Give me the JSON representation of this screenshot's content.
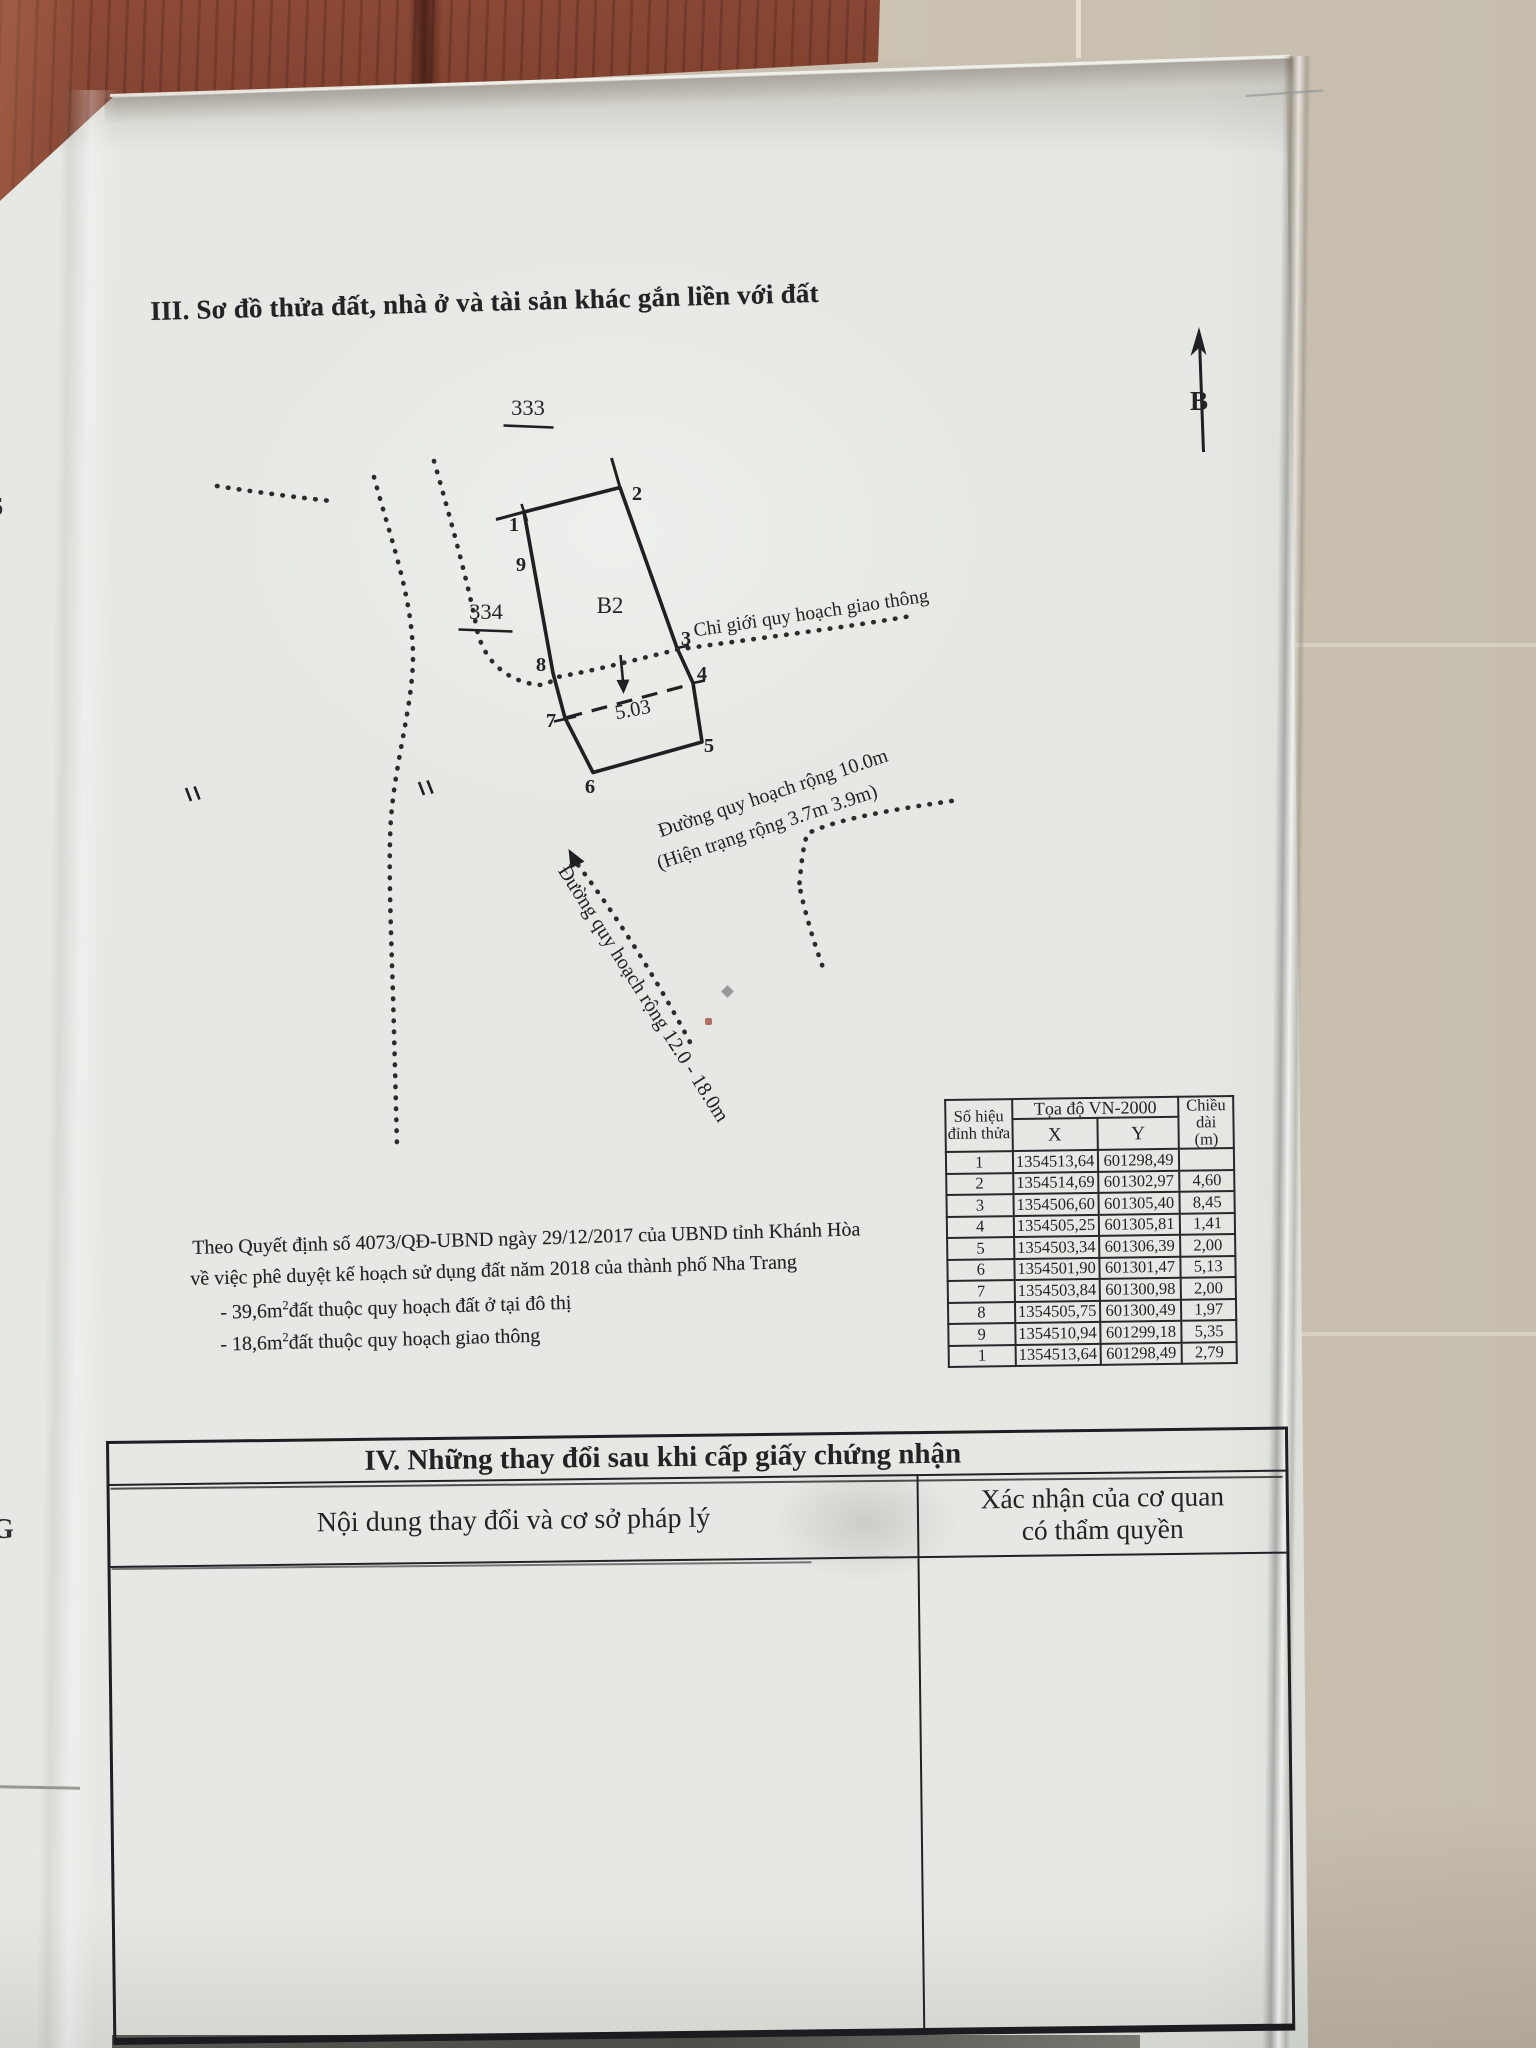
{
  "page": {
    "section3_title": "III. Sơ đồ thửa đất, nhà ở và tài sản khác gắn liền với đất",
    "diagram": {
      "parcel_label": "B2",
      "adjacent_parcel_top": "333",
      "adjacent_parcel_left": "334",
      "north_label": "B",
      "dim_label": "5.03",
      "boundary_label": "Chỉ giới quy hoạch giao thông",
      "road1_line1": "Đường quy hoạch rộng 10.0m",
      "road1_line2": "(Hiện trạng rộng 3.7m 3.9m)",
      "road2": "Đường quy hoạch rộng 12.0 - 18.0m",
      "vertices": [
        "1",
        "2",
        "3",
        "4",
        "5",
        "6",
        "7",
        "8",
        "9"
      ],
      "edge_fragment_top": "6",
      "edge_fragment_bottom": "G"
    },
    "coord_table": {
      "header_col1_line1": "Số hiệu",
      "header_col1_line2": "đỉnh thửa",
      "header_span": "Tọa độ VN-2000",
      "header_x": "X",
      "header_y": "Y",
      "header_len_line1": "Chiều",
      "header_len_line2": "dài",
      "header_len_line3": "(m)",
      "rows": [
        {
          "id": "1",
          "x": "1354513,64",
          "y": "601298,49",
          "len": ""
        },
        {
          "id": "2",
          "x": "1354514,69",
          "y": "601302,97",
          "len": "4,60"
        },
        {
          "id": "3",
          "x": "1354506,60",
          "y": "601305,40",
          "len": "8,45"
        },
        {
          "id": "4",
          "x": "1354505,25",
          "y": "601305,81",
          "len": "1,41"
        },
        {
          "id": "5",
          "x": "1354503,34",
          "y": "601306,39",
          "len": "2,00"
        },
        {
          "id": "6",
          "x": "1354501,90",
          "y": "601301,47",
          "len": "5,13"
        },
        {
          "id": "7",
          "x": "1354503,84",
          "y": "601300,98",
          "len": "2,00"
        },
        {
          "id": "8",
          "x": "1354505,75",
          "y": "601300,49",
          "len": "1,97"
        },
        {
          "id": "9",
          "x": "1354510,94",
          "y": "601299,18",
          "len": "5,35"
        },
        {
          "id": "1",
          "x": "1354513,64",
          "y": "601298,49",
          "len": "2,79"
        }
      ]
    },
    "notes": {
      "line1": "Theo Quyết định số 4073/QĐ-UBND ngày 29/12/2017 của UBND tỉnh Khánh Hòa",
      "line2": "về việc phê duyệt kế hoạch sử dụng đất năm 2018 của thành phố Nha Trang",
      "item1_prefix": "- 39,6m",
      "item1_sup": "2",
      "item1_rest": "đất thuộc quy hoạch đất ở tại đô thị",
      "item2_prefix": "- 18,6m",
      "item2_sup": "2",
      "item2_rest": "đất thuộc quy hoạch giao thông"
    },
    "section4": {
      "title": "IV. Những thay đổi sau khi cấp giấy chứng nhận",
      "col_left": "Nội dung thay đổi và cơ sở pháp lý",
      "col_right_line1": "Xác nhận của cơ quan",
      "col_right_line2": "có thẩm quyền"
    },
    "colors": {
      "ink": "#232326",
      "paper": "#e6e8e3",
      "wood": "#5a2118",
      "tile": "#cdc4b4"
    }
  }
}
